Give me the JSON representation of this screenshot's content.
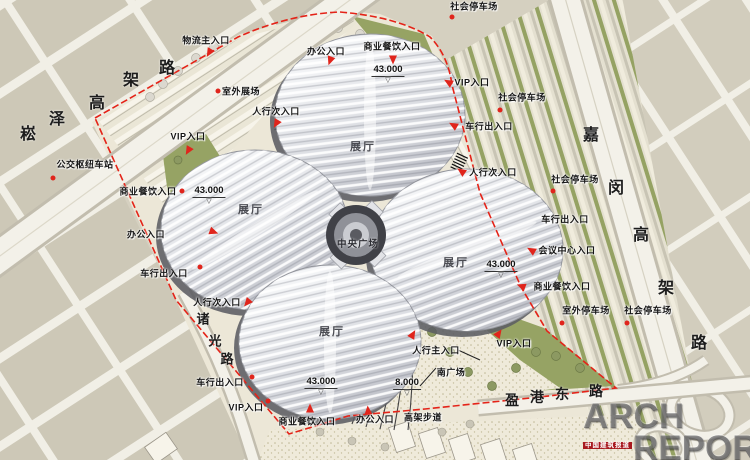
{
  "map": {
    "labels": [
      {
        "text": "物流主入口",
        "x": 206,
        "y": 40
      },
      {
        "text": "社会停车场",
        "x": 474,
        "y": 6
      },
      {
        "text": "办公入口",
        "x": 326,
        "y": 51
      },
      {
        "text": "商业餐饮入口",
        "x": 392,
        "y": 46
      },
      {
        "text": "VIP入口",
        "x": 472,
        "y": 82
      },
      {
        "text": "室外展场",
        "x": 241,
        "y": 91
      },
      {
        "text": "社会停车场",
        "x": 522,
        "y": 97
      },
      {
        "text": "人行次入口",
        "x": 276,
        "y": 111
      },
      {
        "text": "车行出入口",
        "x": 489,
        "y": 126
      },
      {
        "text": "VIP入口",
        "x": 188,
        "y": 136
      },
      {
        "text": "公交枢纽车站",
        "x": 85,
        "y": 164
      },
      {
        "text": "人行次入口",
        "x": 493,
        "y": 172
      },
      {
        "text": "社会停车场",
        "x": 575,
        "y": 179
      },
      {
        "text": "商业餐饮入口",
        "x": 148,
        "y": 191
      },
      {
        "text": "展厅",
        "x": 363,
        "y": 146,
        "kind": "hall"
      },
      {
        "text": "展厅",
        "x": 251,
        "y": 209,
        "kind": "hall"
      },
      {
        "text": "车行出入口",
        "x": 565,
        "y": 219
      },
      {
        "text": "办公入口",
        "x": 146,
        "y": 234
      },
      {
        "text": "中央广场",
        "x": 358,
        "y": 243,
        "kind": "hall-sm"
      },
      {
        "text": "会议中心入口",
        "x": 567,
        "y": 250
      },
      {
        "text": "展厅",
        "x": 456,
        "y": 262,
        "kind": "hall"
      },
      {
        "text": "车行出入口",
        "x": 164,
        "y": 273
      },
      {
        "text": "商业餐饮入口",
        "x": 562,
        "y": 286
      },
      {
        "text": "人行次入口",
        "x": 217,
        "y": 302
      },
      {
        "text": "室外停车场",
        "x": 586,
        "y": 310
      },
      {
        "text": "社会停车场",
        "x": 648,
        "y": 310
      },
      {
        "text": "展厅",
        "x": 332,
        "y": 331,
        "kind": "hall"
      },
      {
        "text": "VIP入口",
        "x": 514,
        "y": 343
      },
      {
        "text": "人行主入口",
        "x": 436,
        "y": 350
      },
      {
        "text": "南广场",
        "x": 451,
        "y": 372
      },
      {
        "text": "车行出入口",
        "x": 220,
        "y": 382
      },
      {
        "text": "VIP入口",
        "x": 246,
        "y": 407
      },
      {
        "text": "商业餐饮入口",
        "x": 307,
        "y": 421
      },
      {
        "text": "办公入口",
        "x": 375,
        "y": 419
      },
      {
        "text": "高架步道",
        "x": 423,
        "y": 417
      }
    ],
    "road_chars": [
      {
        "text": "崧",
        "x": 28,
        "y": 132,
        "s": 16
      },
      {
        "text": "泽",
        "x": 57,
        "y": 117,
        "s": 16
      },
      {
        "text": "高",
        "x": 97,
        "y": 101,
        "s": 16
      },
      {
        "text": "架",
        "x": 131,
        "y": 78,
        "s": 16
      },
      {
        "text": "路",
        "x": 167,
        "y": 66,
        "s": 16
      },
      {
        "text": "嘉",
        "x": 591,
        "y": 133,
        "s": 16
      },
      {
        "text": "闵",
        "x": 616,
        "y": 186,
        "s": 16
      },
      {
        "text": "高",
        "x": 641,
        "y": 233,
        "s": 16
      },
      {
        "text": "架",
        "x": 666,
        "y": 286,
        "s": 16
      },
      {
        "text": "路",
        "x": 699,
        "y": 341,
        "s": 16
      },
      {
        "text": "诸",
        "x": 203,
        "y": 318,
        "s": 13
      },
      {
        "text": "光",
        "x": 215,
        "y": 340,
        "s": 13
      },
      {
        "text": "路",
        "x": 227,
        "y": 358,
        "s": 13
      },
      {
        "text": "盈",
        "x": 512,
        "y": 400,
        "s": 14
      },
      {
        "text": "港",
        "x": 537,
        "y": 397,
        "s": 14
      },
      {
        "text": "东",
        "x": 562,
        "y": 394,
        "s": 14
      },
      {
        "text": "路",
        "x": 596,
        "y": 391,
        "s": 14
      }
    ],
    "elevations": [
      {
        "value": "43.000",
        "x": 388,
        "y": 71
      },
      {
        "value": "43.000",
        "x": 209,
        "y": 192
      },
      {
        "value": "43.000",
        "x": 501,
        "y": 266
      },
      {
        "value": "43.000",
        "x": 321,
        "y": 383
      },
      {
        "value": "8.000",
        "x": 407,
        "y": 384
      }
    ],
    "elev_triangle": "▽",
    "arrows": [
      {
        "x": 209,
        "y": 53,
        "a": 120
      },
      {
        "x": 330,
        "y": 61,
        "a": 110
      },
      {
        "x": 393,
        "y": 60,
        "a": 90
      },
      {
        "x": 448,
        "y": 82,
        "a": 210
      },
      {
        "x": 453,
        "y": 125,
        "a": 210
      },
      {
        "x": 276,
        "y": 124,
        "a": 120
      },
      {
        "x": 188,
        "y": 151,
        "a": 120
      },
      {
        "x": 461,
        "y": 171,
        "a": 215
      },
      {
        "x": 214,
        "y": 232,
        "a": 20
      },
      {
        "x": 531,
        "y": 250,
        "a": 210
      },
      {
        "x": 521,
        "y": 286,
        "a": 200
      },
      {
        "x": 247,
        "y": 303,
        "a": 130
      },
      {
        "x": 413,
        "y": 334,
        "a": -60
      },
      {
        "x": 499,
        "y": 333,
        "a": -55
      },
      {
        "x": 310,
        "y": 408,
        "a": -90
      },
      {
        "x": 368,
        "y": 410,
        "a": -95
      }
    ],
    "dots": [
      {
        "x": 218,
        "y": 91
      },
      {
        "x": 452,
        "y": 17
      },
      {
        "x": 500,
        "y": 110
      },
      {
        "x": 553,
        "y": 191
      },
      {
        "x": 53,
        "y": 178
      },
      {
        "x": 182,
        "y": 191
      },
      {
        "x": 200,
        "y": 267
      },
      {
        "x": 562,
        "y": 323
      },
      {
        "x": 627,
        "y": 323
      },
      {
        "x": 252,
        "y": 377
      },
      {
        "x": 268,
        "y": 401
      }
    ]
  },
  "colors": {
    "marker_red": "#e0251c",
    "boundary_red": "#e42318",
    "roof_gray": "#dfe1e5",
    "green": "#96a364",
    "site_cream": "#ece7d7",
    "city_beige": "#cdc8b7",
    "road_white": "#f3f1e9"
  },
  "watermark": {
    "line1": "ARCH",
    "line2": "REPORT",
    "subtitle": "中国建筑报道"
  }
}
